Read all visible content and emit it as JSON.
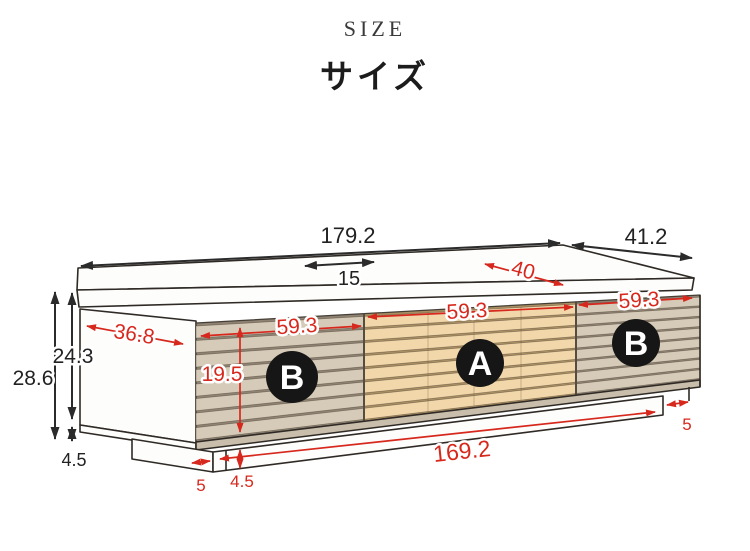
{
  "title": {
    "en": "SIZE",
    "ja": "サイズ"
  },
  "labels": {
    "section_a": "A",
    "section_b": "B"
  },
  "dimensions": {
    "total_width": "179.2",
    "total_depth": "41.2",
    "top_inset": "15",
    "top_surface_depth": "40",
    "total_height": "28.6",
    "body_height": "24.3",
    "base_height_side": "4.5",
    "side_depth": "36.8",
    "section_width": "59.3",
    "door_height": "19.5",
    "base_width": "169.2",
    "base_height_front": "4.5",
    "base_inset_left": "5",
    "base_inset_right": "5"
  },
  "colors": {
    "dimension_red": "#d7281d",
    "outline": "#2f2a25",
    "slat_a_fill": "#f2d7ab",
    "slat_a_gap": "#a98e62",
    "slat_b_fill": "#d6cbb8",
    "slat_b_gap": "#8e8273",
    "badge_bg": "#161616",
    "badge_text": "#ffffff"
  }
}
